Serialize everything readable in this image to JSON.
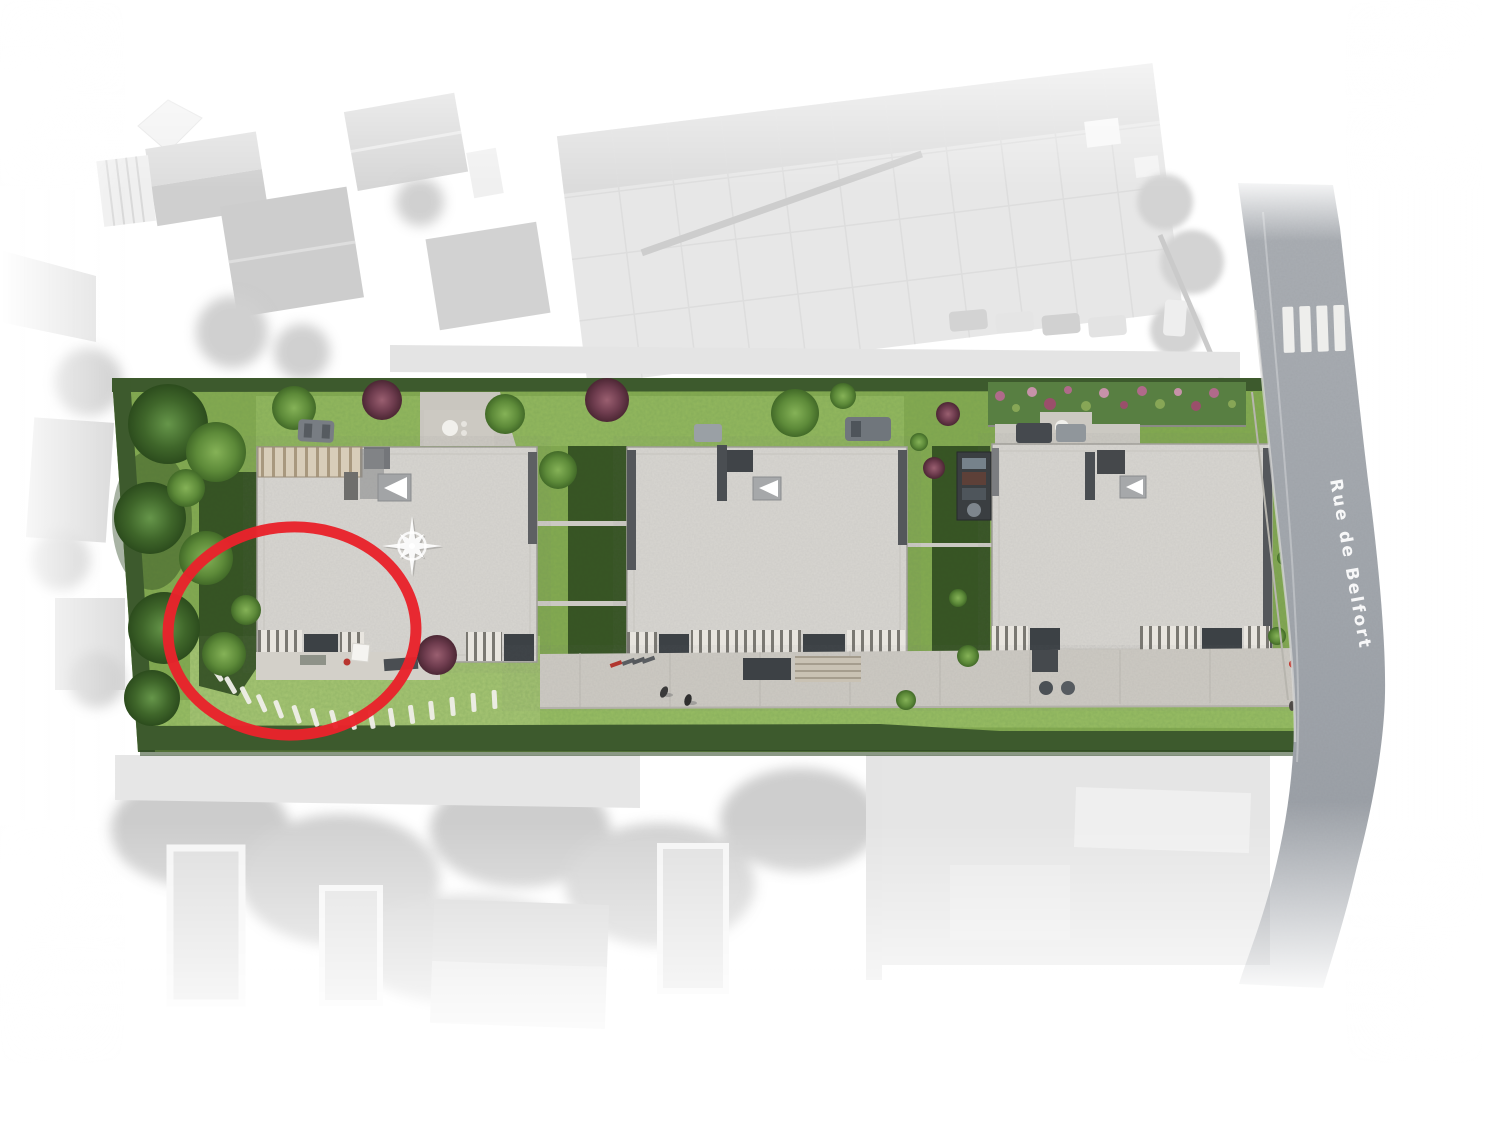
{
  "road": {
    "label": "Rue de Belfort",
    "surface_color": "#a4a9af",
    "marking_color": "#f2f2f0",
    "crosswalk_stripe_count": 4
  },
  "site_plan": {
    "building_count": 3,
    "grass_color": "#84aa50",
    "lawn_light_color": "#98bd63",
    "hedge_color": "#3d5a2d",
    "building_roof_color": "#d8d6d1",
    "pavement_color": "#cdcac3",
    "buildings": [
      {
        "id": "building-1"
      },
      {
        "id": "building-2"
      },
      {
        "id": "building-3"
      }
    ]
  },
  "highlight": {
    "shape": "ellipse",
    "color": "#e8232b"
  },
  "icons": {
    "compass_rose": "compass-rose-icon"
  }
}
